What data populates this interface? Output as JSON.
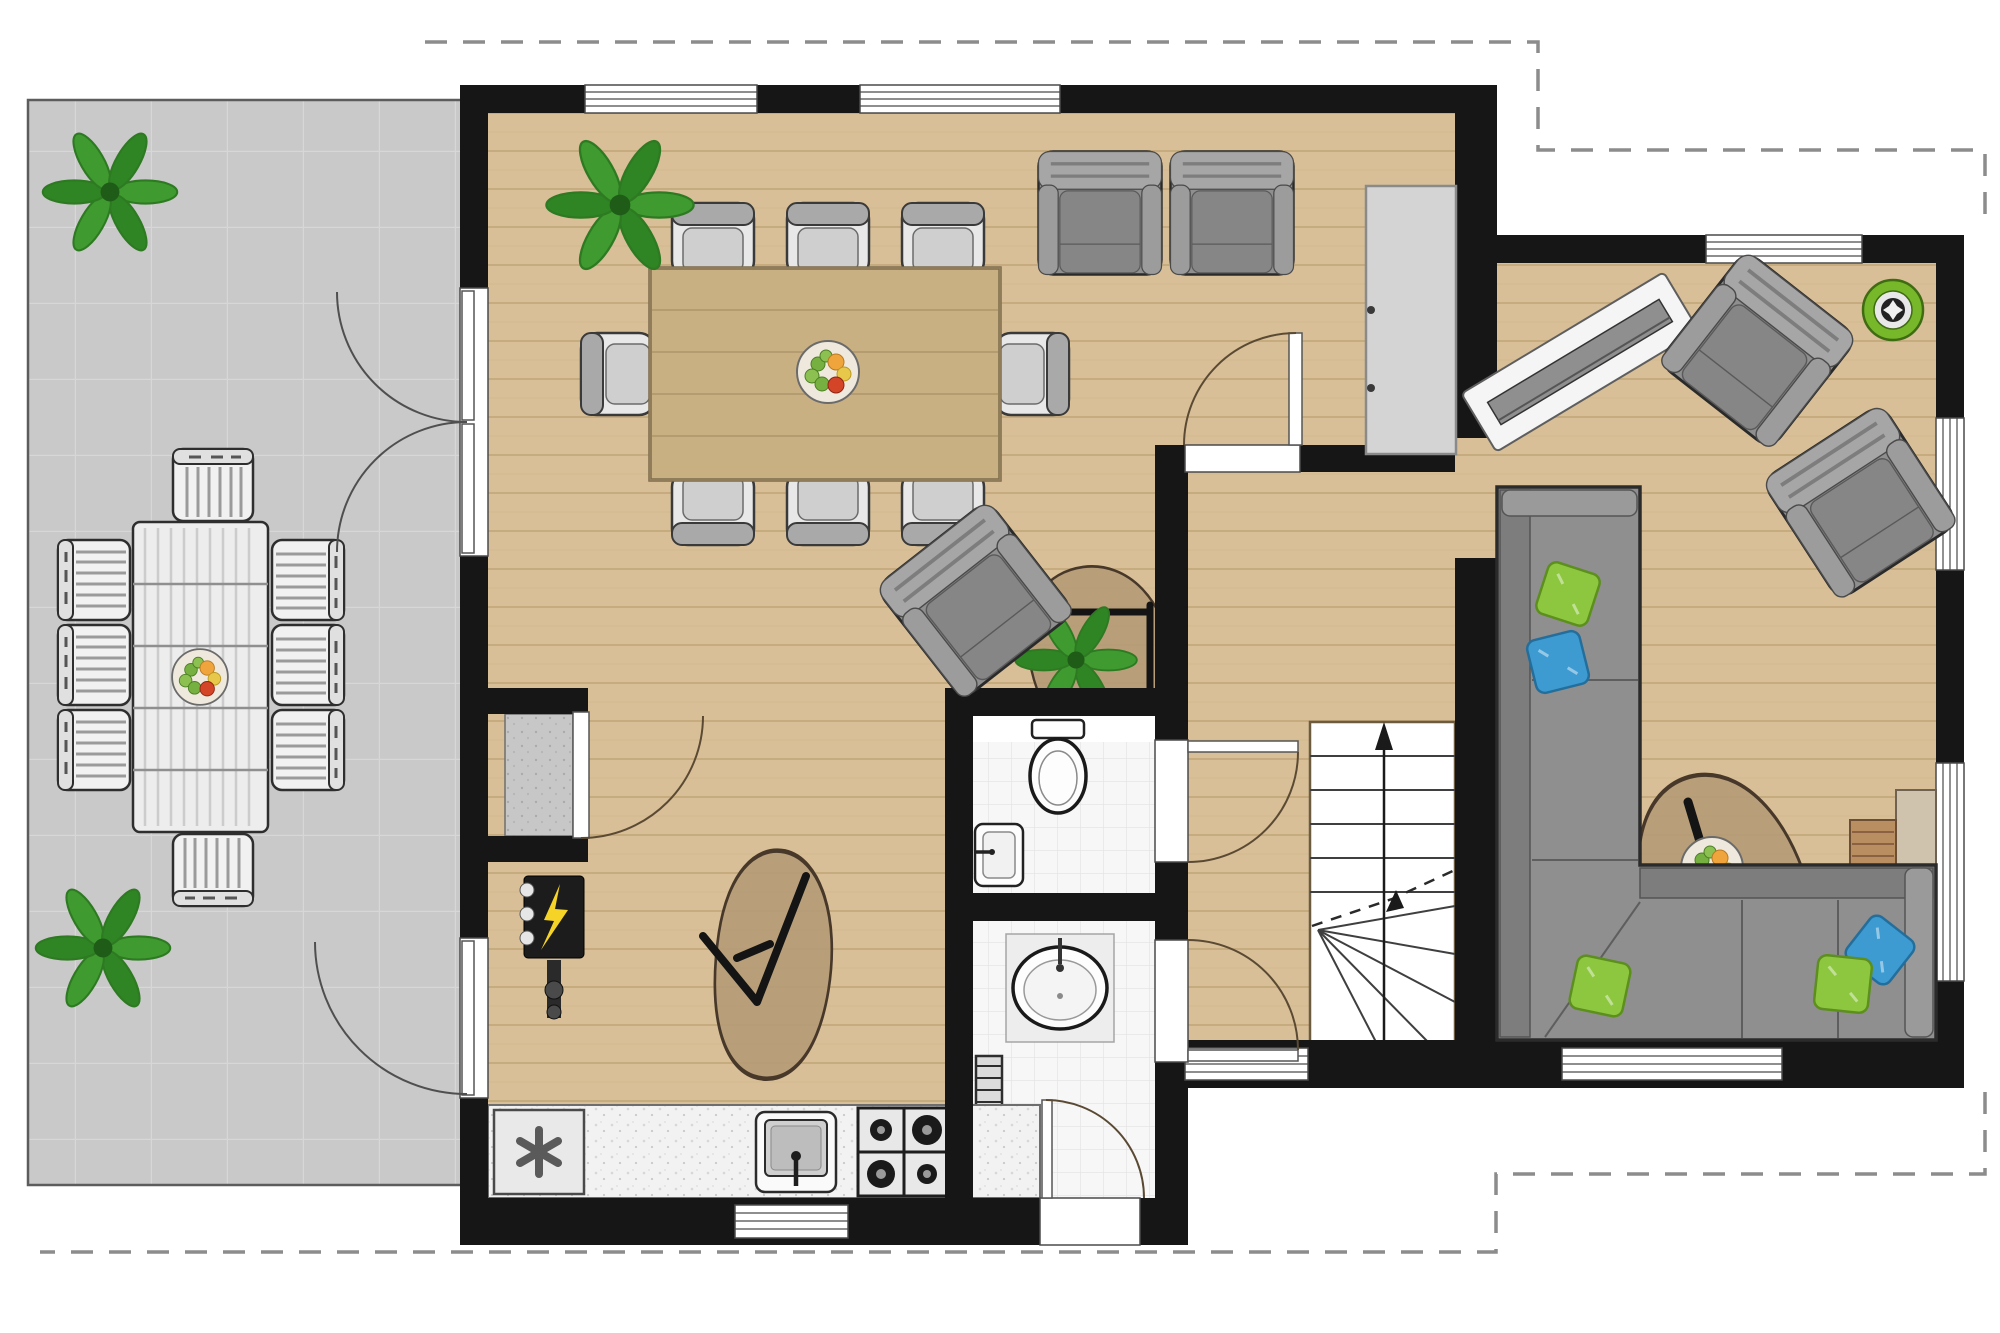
{
  "document": {
    "kind": "architectural floor plan",
    "floor": "ground floor",
    "visible_text": [],
    "notes": "top-down furnished floor plan; no labels or dimensions are printed in the image"
  },
  "palette": {
    "wall": "#161616",
    "wood": "#d8bf97",
    "woodLine": "#c6ab7e",
    "terrace": "#c9c9c9",
    "terraceLine": "#d7d7d7",
    "bathTile": "#f7f7f7",
    "bathTileLine": "#e5e5e5",
    "furnGray": "#8f8f8f",
    "furnGrayDark": "#2b2b2b",
    "chairLight": "#e8e8e8",
    "rug": "#b59b76",
    "rugEdge": "#47382a",
    "plantGreen": "#3f9b2f",
    "plantGreenDark": "#2e7a22",
    "pillowGreen": "#8dc63f",
    "pillowBlue": "#3d9bd1",
    "accentGreenDisc": "#76b82a",
    "tableWood": "#c8b083",
    "dash": "#8c8c8c",
    "doorArc": "#5b4a33",
    "fixtureWhite": "#fdfdfd",
    "applianceYellow": "#f5d327"
  },
  "areas": {
    "terrace": {
      "items": [
        "potted-plant",
        "potted-plant",
        "outdoor-dining-table",
        "outdoor-chairs-x8",
        "fruit-bowl"
      ]
    },
    "dining_room": {
      "items": [
        "potted-plant",
        "dining-table",
        "dining-chairs-x8",
        "fruit-bowl",
        "french-double-door"
      ]
    },
    "living_area": {
      "items": [
        "armchair",
        "armchair",
        "tall-cabinet",
        "angled-armchair",
        "plant-rug",
        "clock-rug",
        "hall-door"
      ]
    },
    "kitchen": {
      "items": [
        "utility-closet",
        "electric-panel",
        "washing-machine",
        "counter",
        "sink",
        "gas-stove",
        "terrace-door",
        "window"
      ]
    },
    "toilet": {
      "items": [
        "wc",
        "corner-hand-basin"
      ]
    },
    "washroom": {
      "items": [
        "round-washbasin",
        "towel-radiator",
        "front-door"
      ]
    },
    "hall": {
      "items": [
        "staircase-up-arrow",
        "toilet-door",
        "washroom-door",
        "window"
      ]
    },
    "sitting_room": {
      "items": [
        "angled-radiator",
        "armchair",
        "armchair",
        "green-round-rug",
        "corner-sofa",
        "pillows-green-blue",
        "coffee-table-rug",
        "fruit-bowl",
        "tv-sideboard",
        "windows"
      ]
    },
    "exterior": {
      "items": [
        "roof-overhang-dashed-outline"
      ]
    }
  },
  "counts": {
    "windows": 8,
    "doors": 7,
    "plants": 4,
    "fruit_bowls": 3,
    "pillows": 5,
    "armchairs": 5,
    "stair_flights": 1
  }
}
